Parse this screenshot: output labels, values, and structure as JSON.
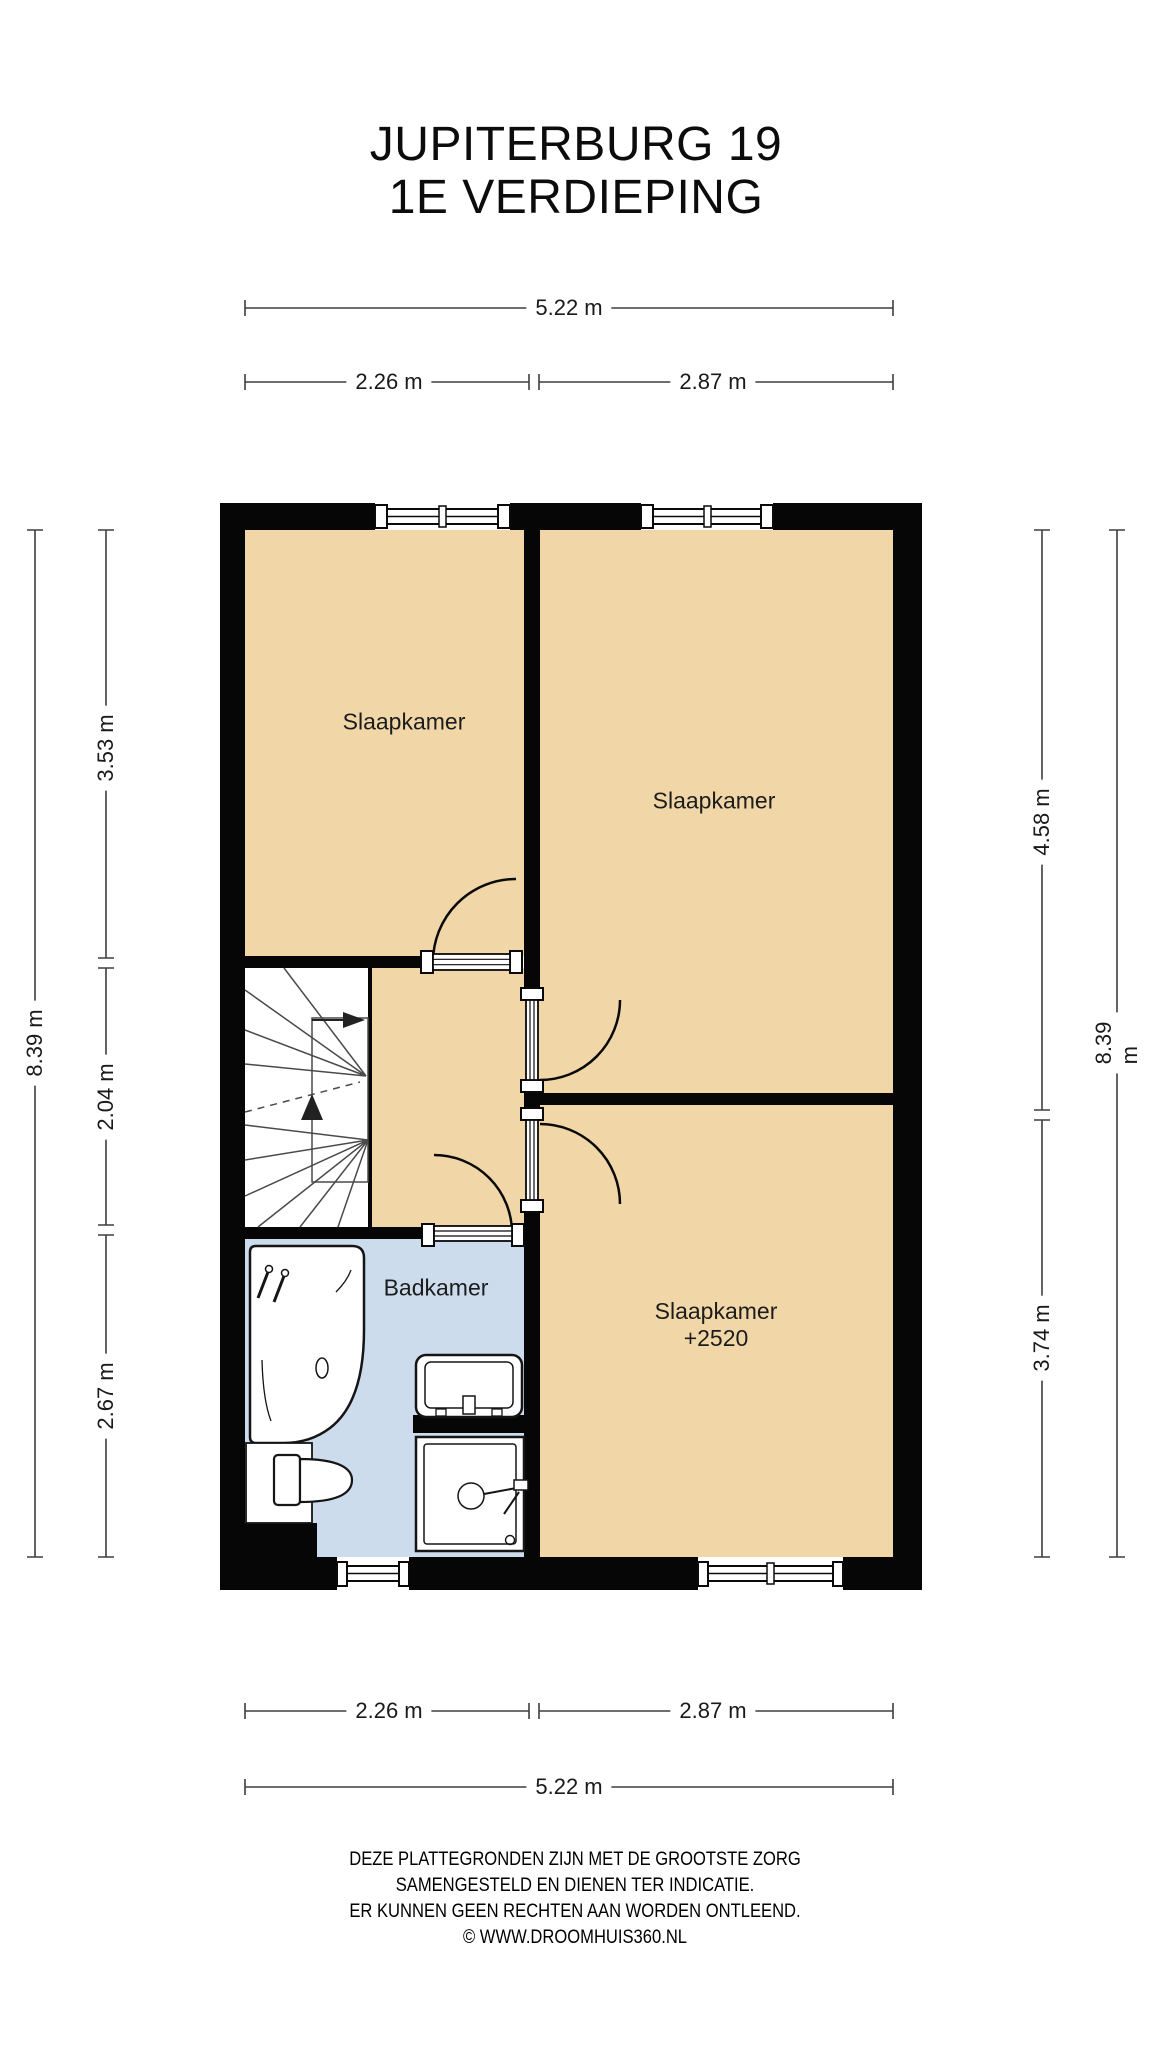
{
  "title": {
    "line1": "JUPITERBURG 19",
    "line2": "1E VERDIEPING"
  },
  "rooms": {
    "bedroom_top_left": "Slaapkamer",
    "bedroom_top_right": "Slaapkamer",
    "bedroom_bottom": "Slaapkamer",
    "bedroom_bottom_level": "+2520",
    "bathroom": "Badkamer"
  },
  "dimensions": {
    "top_total": "5.22 m",
    "top_left": "2.26 m",
    "top_right": "2.87 m",
    "bottom_left": "2.26 m",
    "bottom_right": "2.87 m",
    "bottom_total": "5.22 m",
    "left_total": "8.39 m",
    "left_top": "3.53 m",
    "left_middle": "2.04 m",
    "left_bottom": "2.67 m",
    "right_total": "8.39 m",
    "right_top": "4.58 m",
    "right_bottom": "3.74 m"
  },
  "footer": {
    "line1": "DEZE PLATTEGRONDEN ZIJN MET DE GROOTSTE ZORG",
    "line2": "SAMENGESTELD EN DIENEN TER INDICATIE.",
    "line3": "ER KUNNEN GEEN RECHTEN AAN WORDEN ONTLEEND.",
    "line4": "© WWW.DROOMHUIS360.NL"
  },
  "colors": {
    "floor": "#f1d7a7",
    "bathroom_floor": "#cddcec",
    "wall": "#060606"
  }
}
